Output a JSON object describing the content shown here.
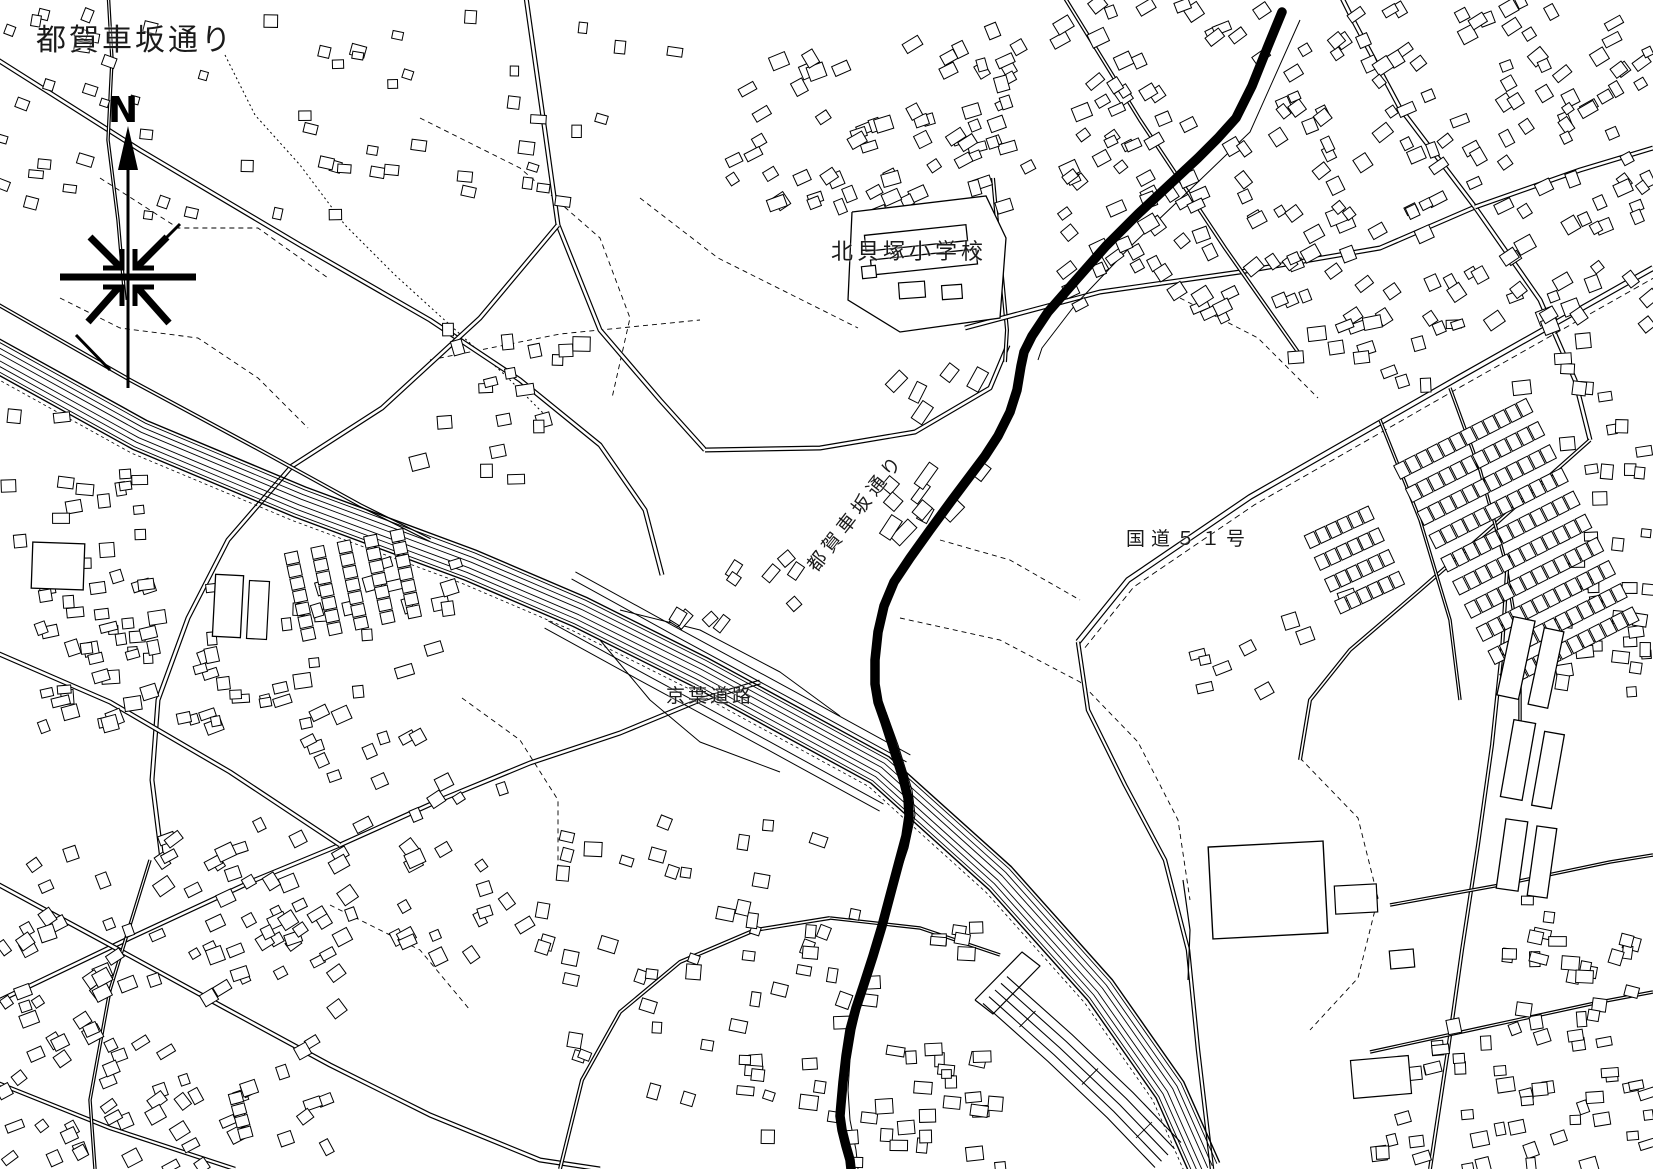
{
  "page": {
    "background_color": "#ffffff",
    "ink_color": "#000000"
  },
  "header": {
    "title": "都賀車坂通り"
  },
  "compass": {
    "label": "N"
  },
  "map_labels": {
    "school": "北貝塚小学校",
    "route_street": "都賀車坂通り",
    "national_route": "国道５１号",
    "expressway": "京葉道路"
  },
  "highlighted_route": {
    "name": "都賀車坂通り",
    "color": "#000000",
    "stroke_width": 9.5,
    "points": [
      [
        1282,
        12
      ],
      [
        1268,
        46
      ],
      [
        1252,
        86
      ],
      [
        1236,
        118
      ],
      [
        1218,
        138
      ],
      [
        1198,
        158
      ],
      [
        1168,
        186
      ],
      [
        1138,
        214
      ],
      [
        1106,
        246
      ],
      [
        1076,
        280
      ],
      [
        1048,
        312
      ],
      [
        1032,
        336
      ],
      [
        1024,
        352
      ],
      [
        1021,
        366
      ],
      [
        1017,
        390
      ],
      [
        1010,
        412
      ],
      [
        998,
        436
      ],
      [
        985,
        456
      ],
      [
        970,
        476
      ],
      [
        952,
        500
      ],
      [
        930,
        530
      ],
      [
        910,
        558
      ],
      [
        894,
        582
      ],
      [
        884,
        606
      ],
      [
        878,
        632
      ],
      [
        875,
        660
      ],
      [
        875,
        684
      ],
      [
        878,
        702
      ],
      [
        885,
        722
      ],
      [
        894,
        750
      ],
      [
        903,
        778
      ],
      [
        908,
        798
      ],
      [
        909,
        816
      ],
      [
        906,
        836
      ],
      [
        899,
        862
      ],
      [
        891,
        892
      ],
      [
        882,
        926
      ],
      [
        873,
        956
      ],
      [
        864,
        984
      ],
      [
        856,
        1008
      ],
      [
        850,
        1030
      ],
      [
        846,
        1056
      ],
      [
        843,
        1082
      ],
      [
        841,
        1104
      ],
      [
        840,
        1116
      ],
      [
        842,
        1130
      ],
      [
        846,
        1146
      ],
      [
        850,
        1160
      ],
      [
        851,
        1169
      ]
    ]
  }
}
